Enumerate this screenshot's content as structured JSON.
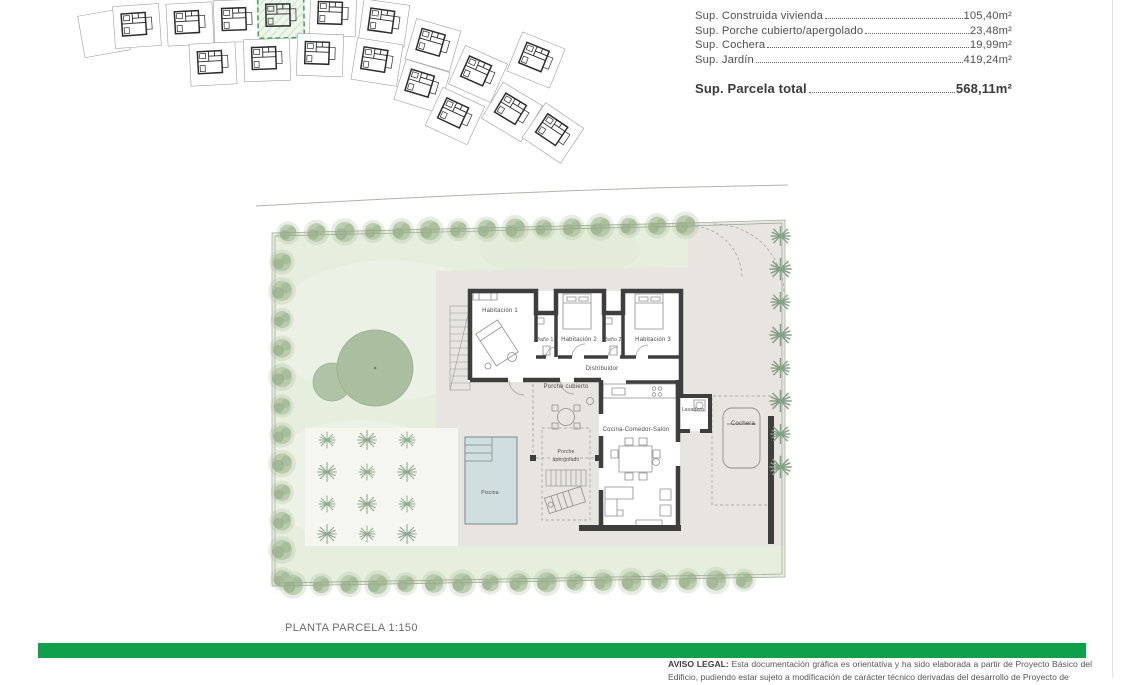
{
  "colors": {
    "accent_green": "#0fa04c",
    "highlight_green": "#3fa84f",
    "hatch_green": "#bcd9ba",
    "hatch_bg": "#eef6ec",
    "garden": "#e6eedd",
    "paved": "#e8e5e0",
    "grid_bg": "#f4f6ef",
    "pool": "#cfdfe0",
    "pool_edge": "#74898b",
    "wall": "#3e3e3e",
    "tree": "#aec39f",
    "tree_dark": "#90a981",
    "palm": "#7fa183",
    "plant": "#8fa98f",
    "boundary": "#9ba793",
    "furniture": "#8d8d8d",
    "label": "#4a4a4a",
    "road": "#b3b3ab",
    "table_text": "#4f4f4f",
    "legal_text": "#555555"
  },
  "area_table": {
    "rows": [
      {
        "label": "Sup. Construida vivienda",
        "value": "105,40m²"
      },
      {
        "label": "Sup. Porche cubierto/apergolado",
        "value": "23,48m²"
      },
      {
        "label": "Sup. Cochera",
        "value": "19,99m²"
      },
      {
        "label": "Sup. Jardín",
        "value": "419,24m²"
      }
    ],
    "total": {
      "label": "Sup. Parcela total",
      "value": "568,11m²"
    }
  },
  "site_map": {
    "highlighted_plot": "plot-4",
    "plots": [
      {
        "x": 104,
        "y": 33,
        "r": -10,
        "empty": true
      },
      {
        "x": 137,
        "y": 26,
        "r": -4
      },
      {
        "x": 190,
        "y": 24,
        "r": -3
      },
      {
        "x": 237,
        "y": 21,
        "r": -2
      },
      {
        "x": 281,
        "y": 17,
        "r": -1,
        "highlighted": true
      },
      {
        "x": 333,
        "y": 15,
        "r": 2
      },
      {
        "x": 384,
        "y": 23,
        "r": 8
      },
      {
        "x": 433,
        "y": 45,
        "r": 16
      },
      {
        "x": 478,
        "y": 74,
        "r": 24
      },
      {
        "x": 512,
        "y": 112,
        "r": 31
      },
      {
        "x": 213,
        "y": 64,
        "r": -3
      },
      {
        "x": 267,
        "y": 60,
        "r": -2
      },
      {
        "x": 320,
        "y": 55,
        "r": 2
      },
      {
        "x": 377,
        "y": 62,
        "r": 9
      },
      {
        "x": 422,
        "y": 86,
        "r": 17
      },
      {
        "x": 455,
        "y": 116,
        "r": 25
      },
      {
        "x": 536,
        "y": 60,
        "r": 22
      },
      {
        "x": 553,
        "y": 133,
        "r": 34
      }
    ]
  },
  "plan": {
    "title": "PLANTA PARCELA 1:150",
    "rooms": [
      {
        "label": "Habitación 1",
        "x": 500,
        "y": 312
      },
      {
        "label": "Baño 1",
        "x": 545,
        "y": 341,
        "size": 5
      },
      {
        "label": "Habitación 2",
        "x": 579,
        "y": 341
      },
      {
        "label": "Baño 2",
        "x": 613,
        "y": 341,
        "size": 5
      },
      {
        "label": "Habitación 3",
        "x": 653,
        "y": 341
      },
      {
        "label": "Distribuidor",
        "x": 602,
        "y": 370
      },
      {
        "label": "Porche cubierto",
        "x": 566,
        "y": 388
      },
      {
        "label": "Cocina-Comedor-Salón",
        "x": 636,
        "y": 431
      },
      {
        "label": "Lavadero",
        "x": 693,
        "y": 411,
        "size": 5
      },
      {
        "label": "Cochera",
        "x": 743,
        "y": 425
      },
      {
        "label": "Porche",
        "x": 566,
        "y": 453,
        "size": 5
      },
      {
        "label": "apergolado",
        "x": 566,
        "y": 461,
        "size": 5
      },
      {
        "label": "Piscina",
        "x": 490,
        "y": 494,
        "size": 5
      }
    ]
  },
  "footer": {
    "legal_label": "AVISO LEGAL:",
    "legal_text": "Esta documentación gráfica es orientativa y ha sido elaborada a partir de Proyecto Básico del Edificio, pudiendo estar sujeto a modificación de carácter técnico derivadas del desarrollo de Proyecto de"
  }
}
